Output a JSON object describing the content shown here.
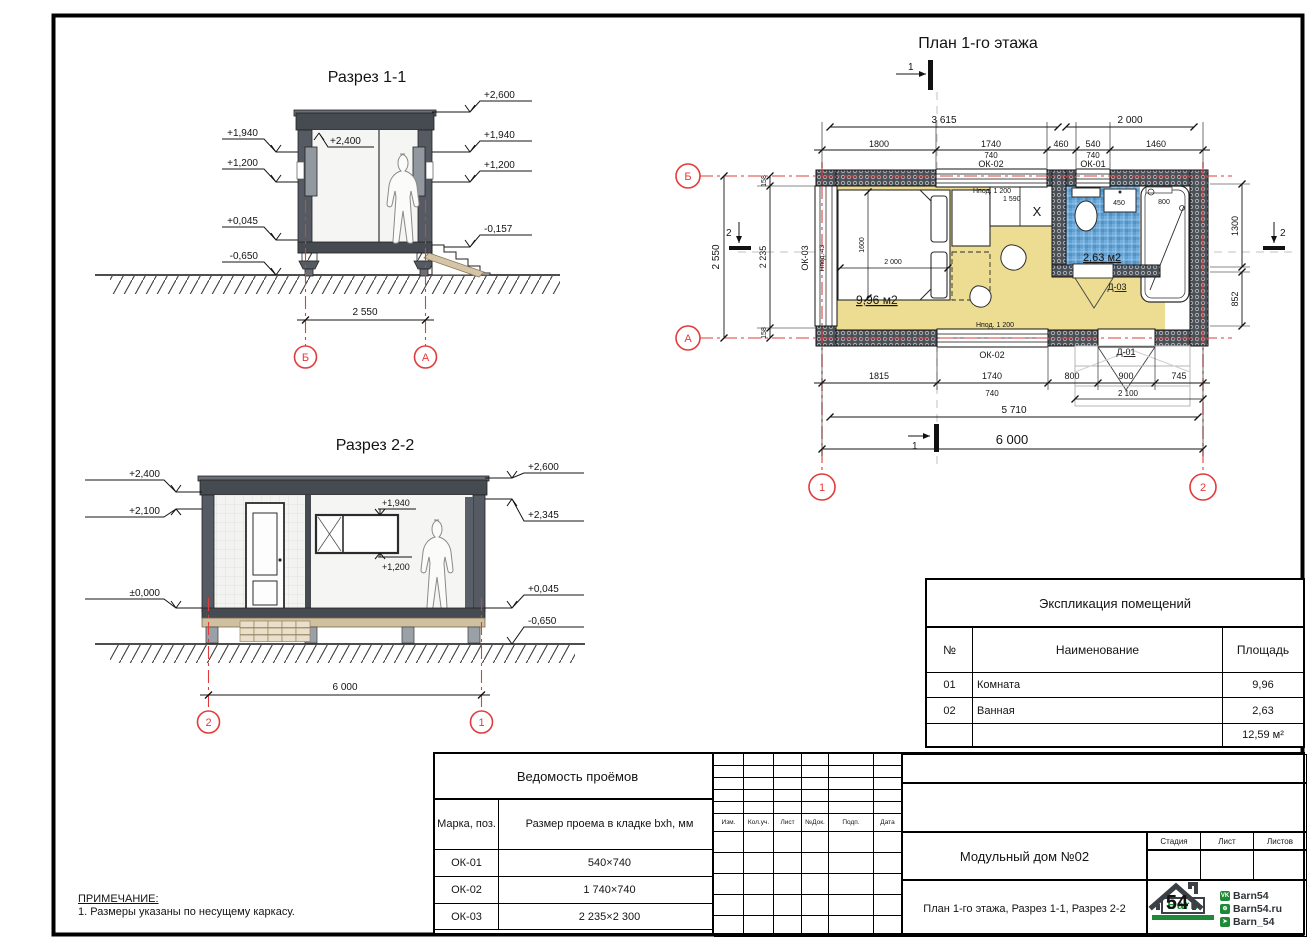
{
  "sheet": {
    "note_title": "ПРИМЕЧАНИЕ:",
    "note_line": "1. Размеры указаны по несущему каркасу."
  },
  "section1": {
    "title": "Разрез 1-1",
    "marks_left": [
      "+1,940",
      "+1,200",
      "+0,045",
      "-0,650"
    ],
    "mark_ceiling": "+2,400",
    "marks_right": [
      "+2,600",
      "+1,940",
      "+1,200",
      "-0,157"
    ],
    "dim_width": "2 550",
    "axis_left": "Б",
    "axis_right": "А"
  },
  "section2": {
    "title": "Разрез 2-2",
    "marks_left": [
      "+2,400",
      "+2,100",
      "±0,000"
    ],
    "marks_right": [
      "+2,600",
      "+2,345",
      "+0,045",
      "-0,650"
    ],
    "window_top": "+1,940",
    "window_bottom": "+1,200",
    "dim_width": "6 000",
    "axis_left": "2",
    "axis_right": "1"
  },
  "plan": {
    "title": "План 1-го этажа",
    "marker_top": "1",
    "marker_bottom": "1",
    "marker_left": "2",
    "marker_right": "2",
    "dim_3615": "3 615",
    "dim_2000": "2 000",
    "dims_row2": [
      "1800",
      "1740",
      "460",
      "540",
      "1460"
    ],
    "sub_740a": "740",
    "sub_740b": "740",
    "win_ok02_top": "ОК-02",
    "win_ok01": "ОК-01",
    "dim_left_total": "2 550",
    "dim_left_158a": "158",
    "dim_left_2235": "2 235",
    "dim_left_158b": "158",
    "win_ok03": "ОК-03",
    "sill_ok03": "Hпод. 43",
    "dim_1300": "1300",
    "dim_852": "852",
    "dims_bottom": [
      "1815",
      "1740",
      "800",
      "900",
      "745"
    ],
    "sub_740c": "740",
    "sub_2100": "2 100",
    "dim_5710": "5 710",
    "dim_6000": "6 000",
    "win_ok02_bottom": "ОК-02",
    "sill_ok02": "Hпод. 1 200",
    "door_d01": "Д-01",
    "door_d03": "Д-03",
    "area_room": "9,96 м2",
    "area_bath": "2,63 м2",
    "bed_1600": "1600",
    "bed_2000": "2 000",
    "counter_sill": "Hпод. 1 200",
    "counter_1590": "1 590",
    "x_mark": "X",
    "bath_sill": "Hпод. 1 200",
    "sink_450": "450",
    "bath_800": "800",
    "axis_b": "Б",
    "axis_a": "А",
    "axis_1": "1",
    "axis_2": "2"
  },
  "explication": {
    "title": "Экспликация помещений",
    "headers": [
      "№",
      "Наименование",
      "Площадь"
    ],
    "rows": [
      [
        "01",
        "Комната",
        "9,96"
      ],
      [
        "02",
        "Ванная",
        "2,63"
      ]
    ],
    "total": "12,59 м²"
  },
  "openings": {
    "title": "Ведомость проёмов",
    "headers": [
      "Марка, поз.",
      "Размер проема в кладке bxh, мм"
    ],
    "rows": [
      [
        "ОК-01",
        "540×740"
      ],
      [
        "ОК-02",
        "1 740×740"
      ],
      [
        "ОК-03",
        "2 235×2 300"
      ]
    ]
  },
  "titleblock": {
    "columns": [
      "Изм.",
      "Кол.уч.",
      "Лист",
      "№Док.",
      "Подп.",
      "Дата"
    ],
    "project": "Модульный дом №02",
    "sheet_name": "План 1-го этажа, Разрез 1-1, Разрез 2-2",
    "stage_headers": [
      "Стадия",
      "Лист",
      "Листов"
    ],
    "logo": {
      "number": "54",
      "name": "Barn",
      "socials": [
        "Barn54",
        "Barn54.ru",
        "Barn_54"
      ]
    }
  },
  "colors": {
    "axis_red": "#e23b3b",
    "wall_dark": "#4b5057",
    "floor_yellow": "#ecdd92",
    "tile_blue": "#5f9fd2",
    "logo_green": "#1e8a38"
  }
}
